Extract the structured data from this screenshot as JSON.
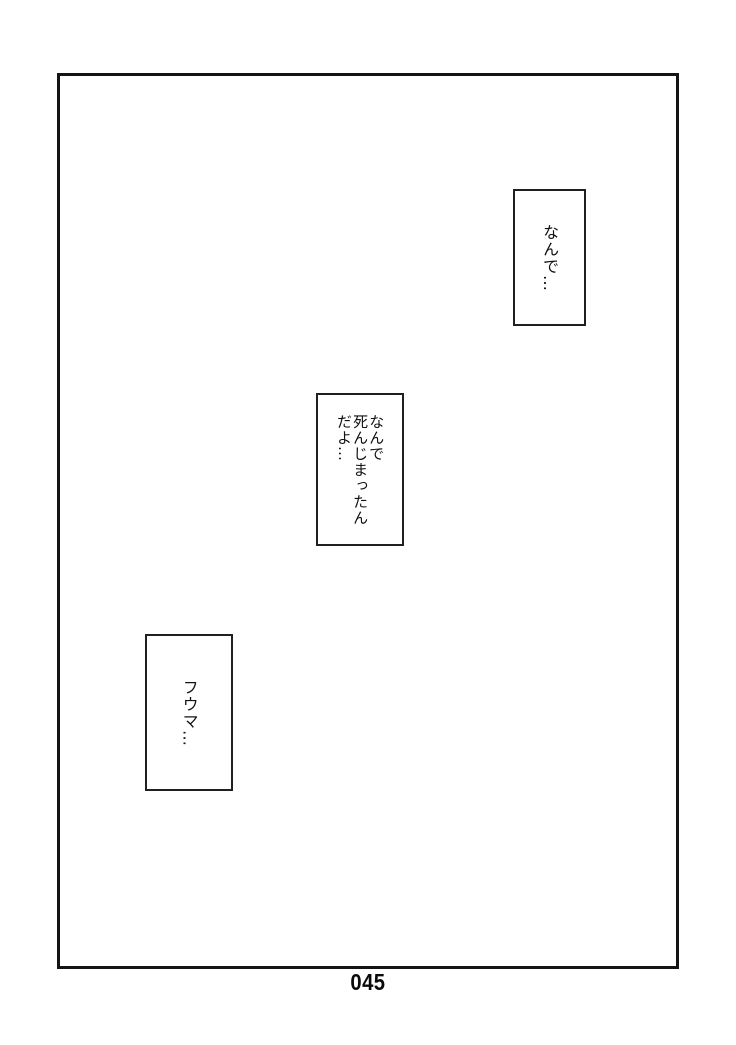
{
  "page": {
    "number": "045"
  },
  "speech_bubbles": [
    {
      "text": "なんで…"
    },
    {
      "text": "なんで\n死んじまったん\nだよ…"
    },
    {
      "text": "フウマ…"
    }
  ]
}
